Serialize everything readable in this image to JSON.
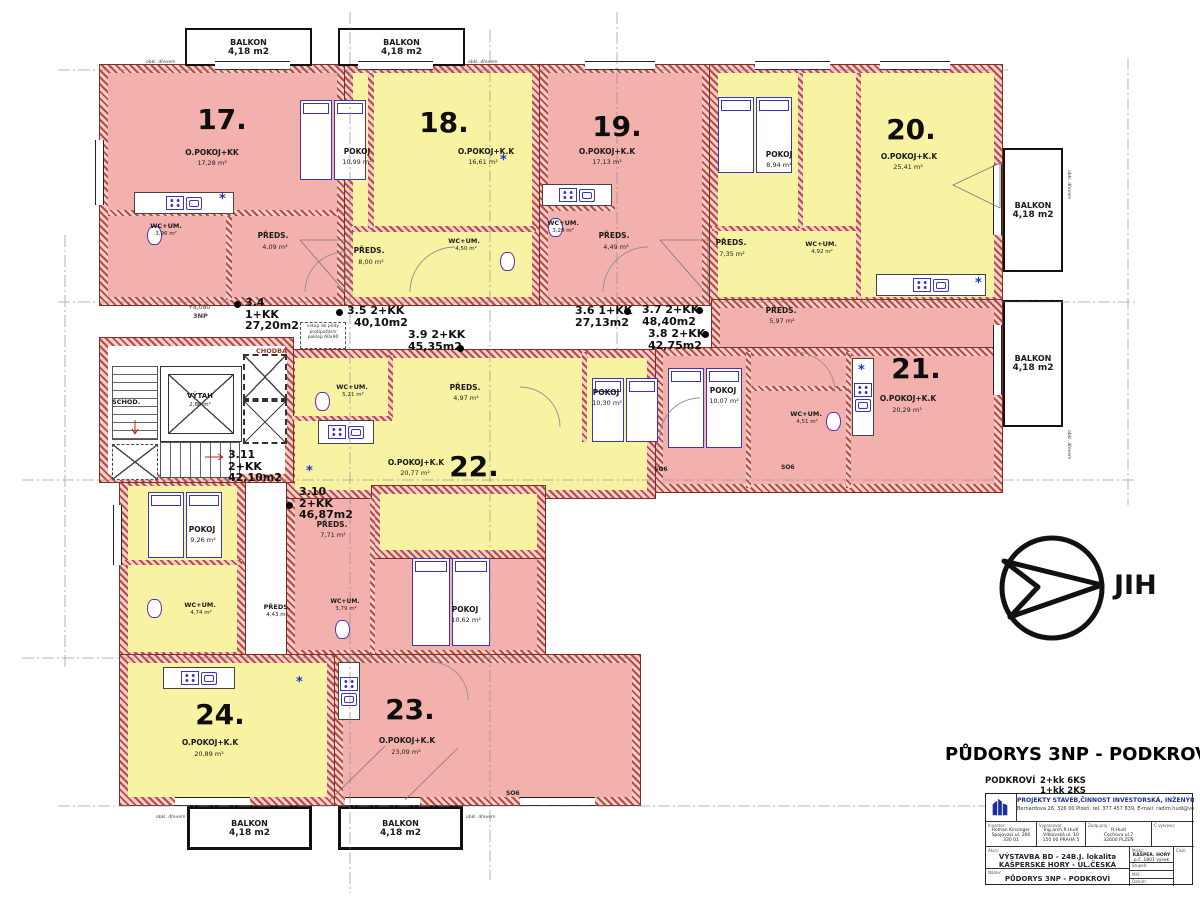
{
  "labels": {
    "balkon": "BALKON",
    "balkon_area": "4,18 m2",
    "obkl": "obkl. dřevem",
    "so6": "SO6",
    "chodba": "CHODBA",
    "schod": "SCHOD.",
    "vytah": "VÝTAH",
    "vytah_area": "2,80 m²",
    "level": "+8,080",
    "level_floor": "3NP",
    "note1": "vstup do půdy",
    "note2": "protipožární",
    "note3": "poklop 60x90",
    "star": "*",
    "jih": "JIH"
  },
  "units": {
    "u34": {
      "no": "3.4",
      "t": "1+KK",
      "a": "27,20m2"
    },
    "u35": {
      "no": "3.5",
      "t": "2+KK",
      "a": "40,10m2"
    },
    "u36": {
      "no": "3.6",
      "t": "1+KK",
      "a": "27,13m2"
    },
    "u37": {
      "no": "3.7",
      "t": "2+KK",
      "a": "48,40m2"
    },
    "u38": {
      "no": "3.8",
      "t": "2+KK",
      "a": "42,75m2"
    },
    "u39": {
      "no": "3.9",
      "t": "2+KK",
      "a": "45,35m2"
    },
    "u310": {
      "no": "3.10",
      "t": "2+KK",
      "a": "46,87m2"
    },
    "u311": {
      "no": "3.11",
      "t": "2+KK",
      "a": "42,10m2"
    }
  },
  "apts": {
    "a17": {
      "num": "17.",
      "main": "O.POKOJ+KK",
      "main_a": "17,28 m²",
      "preds": "PŘEDS.",
      "preds_a": "4,09 m²",
      "wc": "WC+UM.",
      "wc_a": "3,96 m²"
    },
    "a18": {
      "num": "18.",
      "main": "O.POKOJ+K.K",
      "main_a": "16,61 m²",
      "pokoj": "POKOJ",
      "pokoj_a": "10,99 m²",
      "preds": "PŘEDS.",
      "preds_a": "8,00 m²",
      "wc": "WC+UM.",
      "wc_a": "4,50 m²"
    },
    "a19": {
      "num": "19.",
      "main": "O.POKOJ+K.K",
      "main_a": "17,13 m²",
      "preds": "PŘEDS.",
      "preds_a": "4,49 m²",
      "wc": "WC+UM.",
      "wc_a": "3,28 m²"
    },
    "a20": {
      "num": "20.",
      "main": "O.POKOJ+K.K",
      "main_a": "25,41 m²",
      "pokoj": "POKOJ",
      "pokoj_a": "8,94 m²",
      "preds": "PŘEDS.",
      "preds_a": "7,35 m²",
      "wc": "WC+UM.",
      "wc_a": "4,92 m²"
    },
    "a21": {
      "num": "21.",
      "main": "O.POKOJ+K.K",
      "main_a": "20,29 m²",
      "pokoj": "POKOJ",
      "pokoj_a": "10,07 m²",
      "preds": "PŘEDS.",
      "preds_a": "5,97 m²",
      "wc": "WC+UM.",
      "wc_a": "4,51 m²"
    },
    "a22": {
      "num": "22.",
      "main": "O.POKOJ+K.K",
      "main_a": "20,77 m²",
      "pokoj": "POKOJ",
      "pokoj_a": "10,30 m²",
      "preds": "PŘEDS.",
      "preds_a": "4,97 m²",
      "wc": "WC+UM.",
      "wc_a": "5,21 m²"
    },
    "a23": {
      "num": "23.",
      "main": "O.POKOJ+K.K",
      "main_a": "23,09 m²",
      "pokoj": "POKOJ",
      "pokoj_a": "10,62 m²",
      "preds": "PŘEDS.",
      "preds_a": "7,71 m²",
      "wc": "WC+UM.",
      "wc_a": "3,79 m²"
    },
    "a24": {
      "num": "24.",
      "main": "O.POKOJ+K.K",
      "main_a": "20,89 m²",
      "pokoj": "POKOJ",
      "pokoj_a": "9,26 m²",
      "preds": "PŘEDS.",
      "preds_a": "4,43 m²",
      "wc": "WC+UM.",
      "wc_a": "4,74 m²"
    }
  },
  "titleblock": {
    "title": "PŮDORYS 3NP - PODKROVÍ",
    "sum_floor": "PODKROVÍ",
    "sum1": "2+kk 6KS",
    "sum2": "1+kk 2KS",
    "company": "PROJEKTY STAVEB,ČINNOST INVESTORSKÁ, INŽENÝRSKÁ",
    "address": "Bernardova 26, 326 00 Plzeň, tel. 377 457 839, E-mail: radim.hudl@volny.cz",
    "c1_label": "Investor:",
    "c1_l1": "Roman Kinzinger",
    "c1_l2": "Spojovací ul. 266",
    "c1_l3": "330 01",
    "c2_label": "Vypracoval:",
    "c2_l1": "Ing.arch.R.Hudl",
    "c2_l2": "Vítkovská ul. 10",
    "c2_l3": "150 00 PRAHA 5",
    "c3_label": "Zodp.proj.:",
    "c3_l1": "R.Hudl",
    "c3_l2": "Čechova ul.7",
    "c3_l3": "32600 PLZEŇ",
    "c4_label": "Č.výkresu:",
    "akce_label": "Akce:",
    "akce1": "VÝSTAVBA BD - 24B.J.  lokalita",
    "akce2": "KAŠPERSKÉ HORY - UL.ČESKÁ",
    "misto_label": "Místo:",
    "misto1": "KAŠPER. HORY",
    "misto2": "p.č. 1801 výsek",
    "cast_label": "Část:",
    "stupen_label": "Stupeň:",
    "nazev_label": "Název:",
    "nazev": "PŮDORYS 3NP - PODKROVÍ",
    "mer_label": "Měř.:",
    "mer": "1 : 50",
    "datum_label": "Datum:"
  }
}
